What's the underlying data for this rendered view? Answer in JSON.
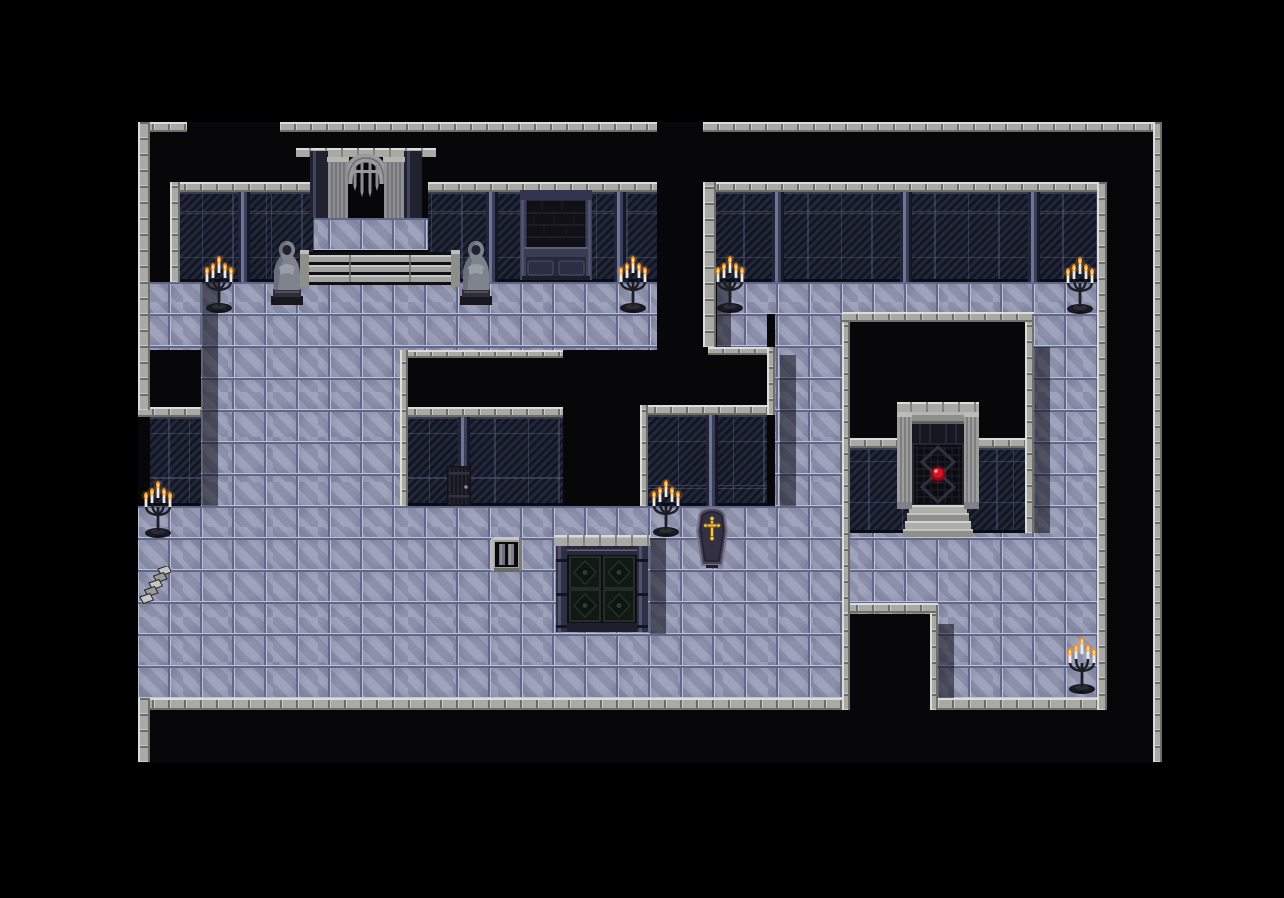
{
  "scene": {
    "kind": "rpg-crypt-dungeon-map",
    "width": 1284,
    "height": 898,
    "map_rect": [
      138,
      122,
      1024,
      641
    ],
    "tile_size": 32
  },
  "palette": {
    "void": "#000000",
    "map_void": "#070709",
    "floor_base": "#8b90ab",
    "floor_line_light": "#bdc1d5",
    "floor_line_dark": "#62678a",
    "wall_base": "#151823",
    "stone_light": "#a9a9a5",
    "stone_highlight": "#dcdcd8",
    "stone_dark": "#6e6e6a",
    "candle_flame": "#ff8e1f",
    "candle_flame_core": "#ffe38a",
    "orb_red": "#d31524",
    "cross_gold": "#f0c44e",
    "shadow": "rgba(7,8,15,0.52)"
  },
  "map": {
    "floors": [
      [
        150,
        282,
        507,
        68
      ],
      [
        201,
        350,
        199,
        156
      ],
      [
        138,
        506,
        704,
        192
      ],
      [
        298,
        218,
        157,
        32
      ],
      [
        717,
        282,
        380,
        32
      ],
      [
        717,
        314,
        50,
        33
      ],
      [
        775,
        314,
        67,
        192
      ],
      [
        1034,
        314,
        63,
        384
      ],
      [
        850,
        533,
        184,
        81
      ],
      [
        938,
        614,
        96,
        84
      ]
    ],
    "shadows": [
      [
        202,
        282,
        16,
        224
      ],
      [
        650,
        538,
        16,
        96
      ],
      [
        780,
        355,
        16,
        151
      ],
      [
        717,
        282,
        14,
        65
      ],
      [
        1034,
        347,
        16,
        186
      ],
      [
        938,
        624,
        16,
        74
      ],
      [
        298,
        218,
        16,
        32
      ]
    ],
    "walls": [
      [
        180,
        192,
        133,
        90
      ],
      [
        428,
        192,
        229,
        90
      ],
      [
        714,
        192,
        383,
        90
      ],
      [
        400,
        417,
        163,
        89
      ],
      [
        648,
        415,
        119,
        91
      ],
      [
        850,
        448,
        175,
        85
      ],
      [
        150,
        417,
        51,
        89
      ]
    ],
    "trims": [
      [
        138,
        122,
        49,
        10
      ],
      [
        280,
        122,
        377,
        10
      ],
      [
        703,
        122,
        450,
        10
      ],
      [
        170,
        182,
        143,
        10
      ],
      [
        428,
        182,
        229,
        10
      ],
      [
        703,
        182,
        404,
        10
      ],
      [
        400,
        407,
        163,
        10
      ],
      [
        640,
        405,
        127,
        10
      ],
      [
        850,
        438,
        175,
        10
      ],
      [
        138,
        407,
        63,
        10
      ],
      [
        400,
        350,
        163,
        8
      ],
      [
        708,
        347,
        59,
        8
      ],
      [
        842,
        312,
        192,
        10
      ],
      [
        842,
        603,
        96,
        10
      ],
      [
        138,
        698,
        704,
        12
      ],
      [
        938,
        698,
        169,
        12
      ]
    ],
    "edges": [
      [
        138,
        122,
        12,
        288
      ],
      [
        138,
        698,
        12,
        64
      ],
      [
        1153,
        122,
        9,
        640
      ],
      [
        170,
        182,
        10,
        100
      ],
      [
        703,
        182,
        13,
        165
      ],
      [
        1097,
        182,
        10,
        528
      ],
      [
        400,
        350,
        8,
        156
      ],
      [
        640,
        405,
        8,
        101
      ],
      [
        767,
        347,
        8,
        68
      ],
      [
        842,
        322,
        8,
        291
      ],
      [
        1025,
        322,
        9,
        211
      ],
      [
        842,
        613,
        8,
        97
      ],
      [
        930,
        613,
        8,
        97
      ]
    ],
    "objects": [
      {
        "type": "portcullis-gate",
        "rect": [
          296,
          148,
          140,
          70
        ],
        "interactable": true
      },
      {
        "type": "stone-railing",
        "rect": [
          300,
          250,
          160,
          37
        ],
        "interactable": false
      },
      {
        "type": "wall-window",
        "rect": [
          520,
          190,
          72,
          90
        ],
        "interactable": false
      },
      {
        "type": "cloaked-statue",
        "rect": [
          266,
          238,
          42,
          68
        ],
        "interactable": false
      },
      {
        "type": "cloaked-statue",
        "rect": [
          455,
          238,
          42,
          68
        ],
        "interactable": false
      },
      {
        "type": "candelabra",
        "rect": [
          202,
          252,
          34,
          62
        ],
        "interactable": false
      },
      {
        "type": "candelabra",
        "rect": [
          616,
          252,
          34,
          62
        ],
        "interactable": false
      },
      {
        "type": "candelabra",
        "rect": [
          713,
          252,
          34,
          62
        ],
        "interactable": false
      },
      {
        "type": "candelabra",
        "rect": [
          1063,
          253,
          34,
          62
        ],
        "interactable": false
      },
      {
        "type": "candelabra",
        "rect": [
          649,
          476,
          34,
          62
        ],
        "interactable": false
      },
      {
        "type": "candelabra",
        "rect": [
          141,
          477,
          34,
          62
        ],
        "interactable": false
      },
      {
        "type": "candelabra",
        "rect": [
          1065,
          633,
          34,
          62
        ],
        "interactable": false
      },
      {
        "type": "cell-door",
        "rect": [
          447,
          466,
          24,
          40
        ],
        "interactable": true
      },
      {
        "type": "floor-grate",
        "rect": [
          491,
          537,
          31,
          34
        ],
        "interactable": true
      },
      {
        "type": "crypt-double-door",
        "rect": [
          554,
          535,
          96,
          99
        ],
        "interactable": true
      },
      {
        "type": "coffin",
        "rect": [
          694,
          507,
          36,
          62
        ],
        "interactable": true
      },
      {
        "type": "sealed-gate-red-orb",
        "rect": [
          897,
          402,
          82,
          135
        ],
        "interactable": true
      },
      {
        "type": "stone-stairs",
        "rect": [
          138,
          566,
          33,
          38
        ],
        "interactable": true
      }
    ]
  }
}
